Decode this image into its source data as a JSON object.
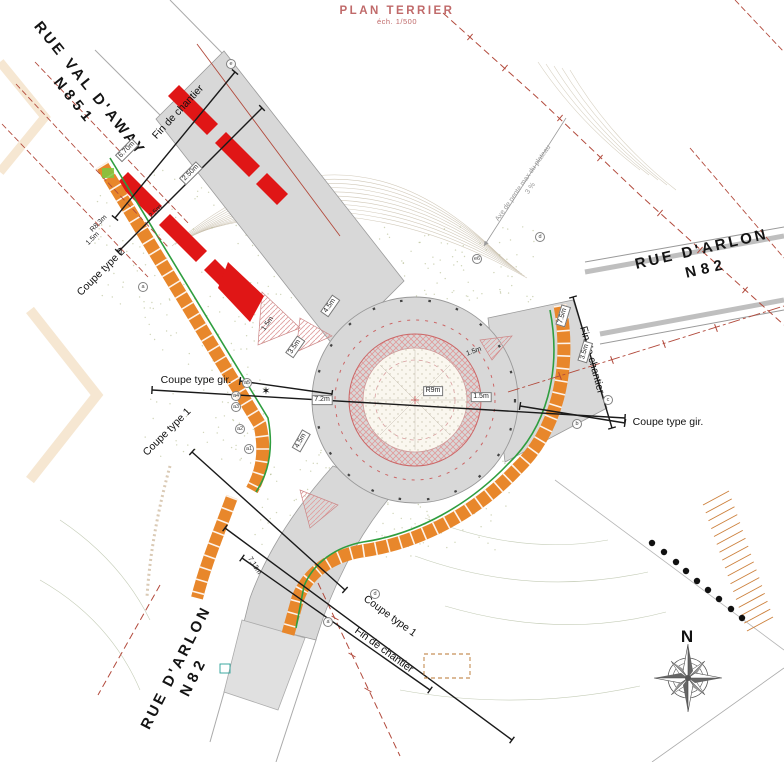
{
  "title": {
    "main": "PLAN TERRIER",
    "scale": "éch. 1/500"
  },
  "compass": {
    "north_label": "N"
  },
  "slope_note": {
    "line1": "Axe de pente max du plateau",
    "line2": "3 %"
  },
  "center_symbol": "✶",
  "streets": [
    {
      "name": "RUE VAL D'AWAY",
      "ref": "N851",
      "x": 82,
      "y": 95,
      "rot": 51
    },
    {
      "name": "RUE D'ARLON",
      "ref": "N82",
      "x": 704,
      "y": 259,
      "rot": -13
    },
    {
      "name": "RUE D'ARLON",
      "ref": "N82",
      "x": 185,
      "y": 672,
      "rot": -63
    }
  ],
  "section_labels": [
    {
      "text": "Fin de chantier",
      "x": 178,
      "y": 112,
      "rot": -47
    },
    {
      "text": "Coupe type 2",
      "x": 101,
      "y": 272,
      "rot": -45
    },
    {
      "text": "Coupe type gir.",
      "x": 196,
      "y": 380,
      "rot": 0
    },
    {
      "text": "Coupe type 1",
      "x": 167,
      "y": 432,
      "rot": -45
    },
    {
      "text": "Coupe type gir.",
      "x": 668,
      "y": 422,
      "rot": 0
    },
    {
      "text": "Fin de chantier",
      "x": 592,
      "y": 360,
      "rot": 75
    },
    {
      "text": "Coupe type 1",
      "x": 390,
      "y": 616,
      "rot": 36
    },
    {
      "text": "Fin de chantier",
      "x": 384,
      "y": 650,
      "rot": 36
    }
  ],
  "dimension_labels": [
    {
      "text": "6.70m",
      "x": 127,
      "y": 150,
      "rot": -45,
      "boxed": true
    },
    {
      "text": "2.50m",
      "x": 191,
      "y": 173,
      "rot": -45,
      "boxed": true
    },
    {
      "text": "2.5m",
      "x": 156,
      "y": 212,
      "rot": -45,
      "boxed": false
    },
    {
      "text": "R8.3m",
      "x": 99,
      "y": 224,
      "rot": -45,
      "boxed": false
    },
    {
      "text": "1.5m",
      "x": 93,
      "y": 239,
      "rot": -45,
      "boxed": false
    },
    {
      "text": "4.5m",
      "x": 330,
      "y": 306,
      "rot": -55,
      "boxed": true
    },
    {
      "text": "3.5m",
      "x": 295,
      "y": 347,
      "rot": -55,
      "boxed": true
    },
    {
      "text": "1.5m",
      "x": 268,
      "y": 324,
      "rot": -55,
      "boxed": false
    },
    {
      "text": "7.2m",
      "x": 322,
      "y": 400,
      "rot": 0,
      "boxed": true
    },
    {
      "text": "R9m",
      "x": 433,
      "y": 391,
      "rot": 0,
      "boxed": true
    },
    {
      "text": "1.5m",
      "x": 481,
      "y": 397,
      "rot": 0,
      "boxed": true
    },
    {
      "text": "4.5m",
      "x": 301,
      "y": 441,
      "rot": -60,
      "boxed": true
    },
    {
      "text": "7.5m",
      "x": 563,
      "y": 316,
      "rot": -73,
      "boxed": true
    },
    {
      "text": "3.5m",
      "x": 585,
      "y": 352,
      "rot": -73,
      "boxed": true
    },
    {
      "text": "7.13m",
      "x": 254,
      "y": 566,
      "rot": 58,
      "boxed": false
    },
    {
      "text": "1.5m",
      "x": 474,
      "y": 352,
      "rot": -20,
      "boxed": false
    }
  ],
  "survey_markers": [
    {
      "text": "e",
      "x": 231,
      "y": 64
    },
    {
      "text": "a",
      "x": 143,
      "y": 287
    },
    {
      "text": "a5",
      "x": 247,
      "y": 383
    },
    {
      "text": "a4",
      "x": 236,
      "y": 396
    },
    {
      "text": "a3",
      "x": 236,
      "y": 407
    },
    {
      "text": "a2",
      "x": 240,
      "y": 429
    },
    {
      "text": "a1",
      "x": 249,
      "y": 449
    },
    {
      "text": "e6",
      "x": 477,
      "y": 259
    },
    {
      "text": "d",
      "x": 540,
      "y": 237
    },
    {
      "text": "c",
      "x": 608,
      "y": 400
    },
    {
      "text": "b",
      "x": 577,
      "y": 424
    },
    {
      "text": "d",
      "x": 375,
      "y": 594
    },
    {
      "text": "a",
      "x": 328,
      "y": 622
    }
  ],
  "colors": {
    "road": "#d8d8d8",
    "road-edge": "#9b9b9b",
    "works-orange": "#e8872b",
    "works-red": "#e01616",
    "green-line": "#2f9e3f",
    "boundary": "#b24a3c",
    "island-hatch": "#e09a9a",
    "stipple": "#a9b37f",
    "contour": "#c9c0ad",
    "title": "#c06a6a"
  }
}
